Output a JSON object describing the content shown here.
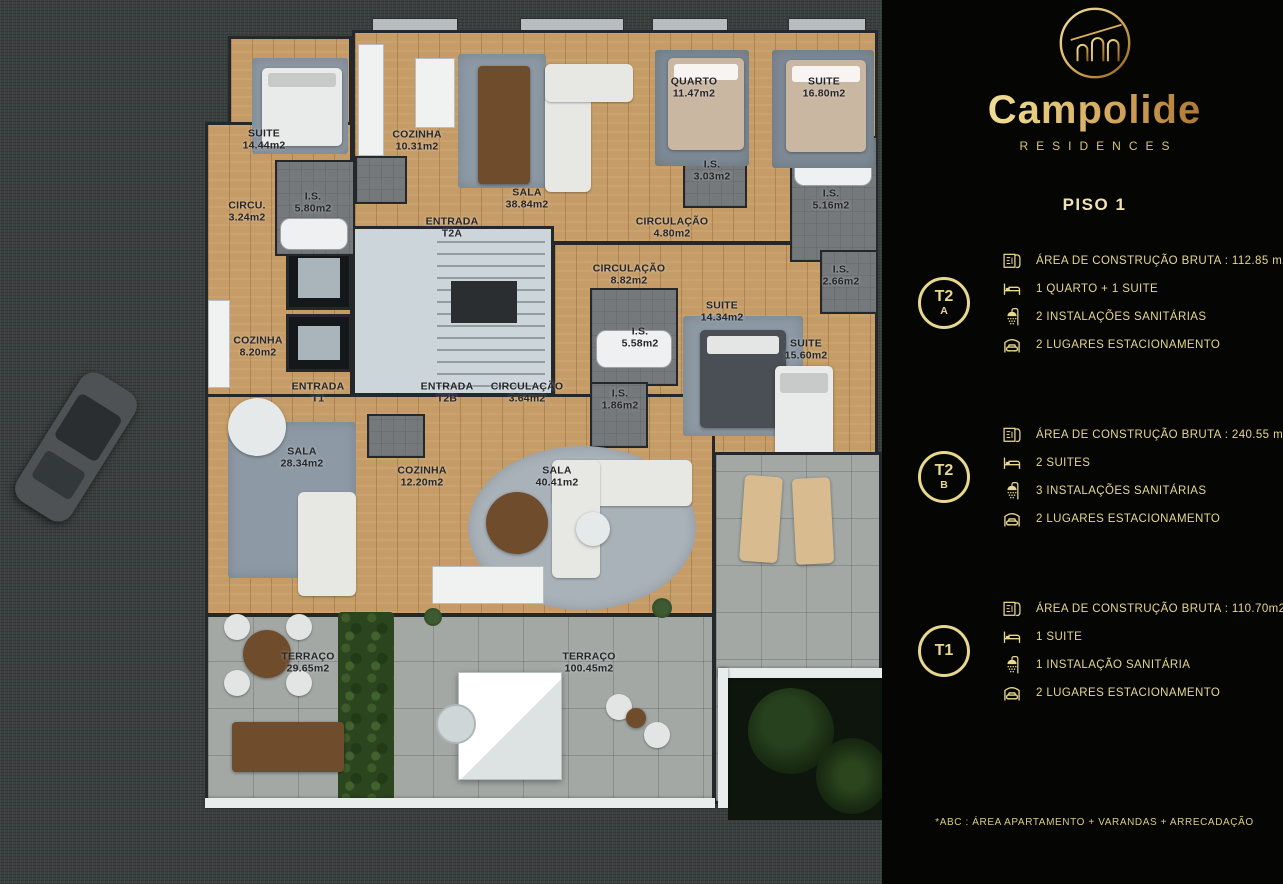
{
  "brand": {
    "name": "Campolide",
    "subtitle": "RESIDENCES",
    "logo": "aqueduct-arches-icon"
  },
  "panel": {
    "title": "PISO 1",
    "units": [
      {
        "badge_main": "T2",
        "badge_sub": "A",
        "specs": [
          {
            "icon": "floorplan-document-icon",
            "text": "ÁREA DE CONSTRUÇÃO BRUTA :  112.85 m2*"
          },
          {
            "icon": "bed-icon",
            "text": "1 QUARTO + 1 SUITE"
          },
          {
            "icon": "shower-icon",
            "text": "2 INSTALAÇÕES SANITÁRIAS"
          },
          {
            "icon": "garage-car-icon",
            "text": "2 LUGARES ESTACIONAMENTO"
          }
        ]
      },
      {
        "badge_main": "T2",
        "badge_sub": "B",
        "specs": [
          {
            "icon": "floorplan-document-icon",
            "text": "ÁREA DE CONSTRUÇÃO BRUTA :  240.55 m2*"
          },
          {
            "icon": "bed-icon",
            "text": "2 SUITES"
          },
          {
            "icon": "shower-icon",
            "text": "3 INSTALAÇÕES SANITÁRIAS"
          },
          {
            "icon": "garage-car-icon",
            "text": "2 LUGARES ESTACIONAMENTO"
          }
        ]
      },
      {
        "badge_main": "T1",
        "badge_sub": "",
        "specs": [
          {
            "icon": "floorplan-document-icon",
            "text": "ÁREA DE CONSTRUÇÃO BRUTA :  110.70m2*"
          },
          {
            "icon": "bed-icon",
            "text": "1 SUITE"
          },
          {
            "icon": "shower-icon",
            "text": "1 INSTALAÇÃO SANITÁRIA"
          },
          {
            "icon": "garage-car-icon",
            "text": "2 LUGARES ESTACIONAMENTO"
          }
        ]
      }
    ],
    "footnote": "*ABC :  ÁREA APARTAMENTO + VARANDAS + ARRECADAÇÃO"
  },
  "floorplan": {
    "labels": [
      {
        "name": "SUITE",
        "area": "14.44m2",
        "x": 264,
        "y": 140
      },
      {
        "name": "COZINHA",
        "area": "10.31m2",
        "x": 417,
        "y": 141
      },
      {
        "name": "SALA",
        "area": "38.84m2",
        "x": 527,
        "y": 199
      },
      {
        "name": "I.S.",
        "area": "5.80m2",
        "x": 313,
        "y": 203
      },
      {
        "name": "CIRCU.",
        "area": "3.24m2",
        "x": 247,
        "y": 212
      },
      {
        "name": "ENTRADA",
        "area": "T2A",
        "x": 452,
        "y": 228
      },
      {
        "name": "QUARTO",
        "area": "11.47m2",
        "x": 694,
        "y": 88
      },
      {
        "name": "SUITE",
        "area": "16.80m2",
        "x": 824,
        "y": 88
      },
      {
        "name": "I.S.",
        "area": "3.03m2",
        "x": 712,
        "y": 171
      },
      {
        "name": "I.S.",
        "area": "5.16m2",
        "x": 831,
        "y": 200
      },
      {
        "name": "CIRCULAÇÃO",
        "area": "4.80m2",
        "x": 672,
        "y": 228
      },
      {
        "name": "CIRCULAÇÃO",
        "area": "8.82m2",
        "x": 629,
        "y": 275
      },
      {
        "name": "I.S.",
        "area": "2.66m2",
        "x": 841,
        "y": 276
      },
      {
        "name": "SUITE",
        "area": "14.34m2",
        "x": 722,
        "y": 312
      },
      {
        "name": "I.S.",
        "area": "5.58m2",
        "x": 640,
        "y": 338
      },
      {
        "name": "SUITE",
        "area": "15.60m2",
        "x": 806,
        "y": 350
      },
      {
        "name": "I.S.",
        "area": "1.86m2",
        "x": 620,
        "y": 400
      },
      {
        "name": "COZINHA",
        "area": "8.20m2",
        "x": 258,
        "y": 347
      },
      {
        "name": "ENTRADA",
        "area": "T1",
        "x": 318,
        "y": 393
      },
      {
        "name": "ENTRADA",
        "area": "T2B",
        "x": 447,
        "y": 393
      },
      {
        "name": "CIRCULAÇÃO",
        "area": "3.64m2",
        "x": 527,
        "y": 393
      },
      {
        "name": "SALA",
        "area": "28.34m2",
        "x": 302,
        "y": 458
      },
      {
        "name": "COZINHA",
        "area": "12.20m2",
        "x": 422,
        "y": 477
      },
      {
        "name": "SALA",
        "area": "40.41m2",
        "x": 557,
        "y": 477
      },
      {
        "name": "TERRAÇO",
        "area": "29.65m2",
        "x": 308,
        "y": 663
      },
      {
        "name": "TERRAÇO",
        "area": "100.45m2",
        "x": 589,
        "y": 663
      }
    ]
  },
  "colors": {
    "gold": "#e8d88f",
    "wall": "#24282b",
    "wood": "#c59c67",
    "terrace": "#a3a8a5",
    "panel_bg": "#050503"
  }
}
